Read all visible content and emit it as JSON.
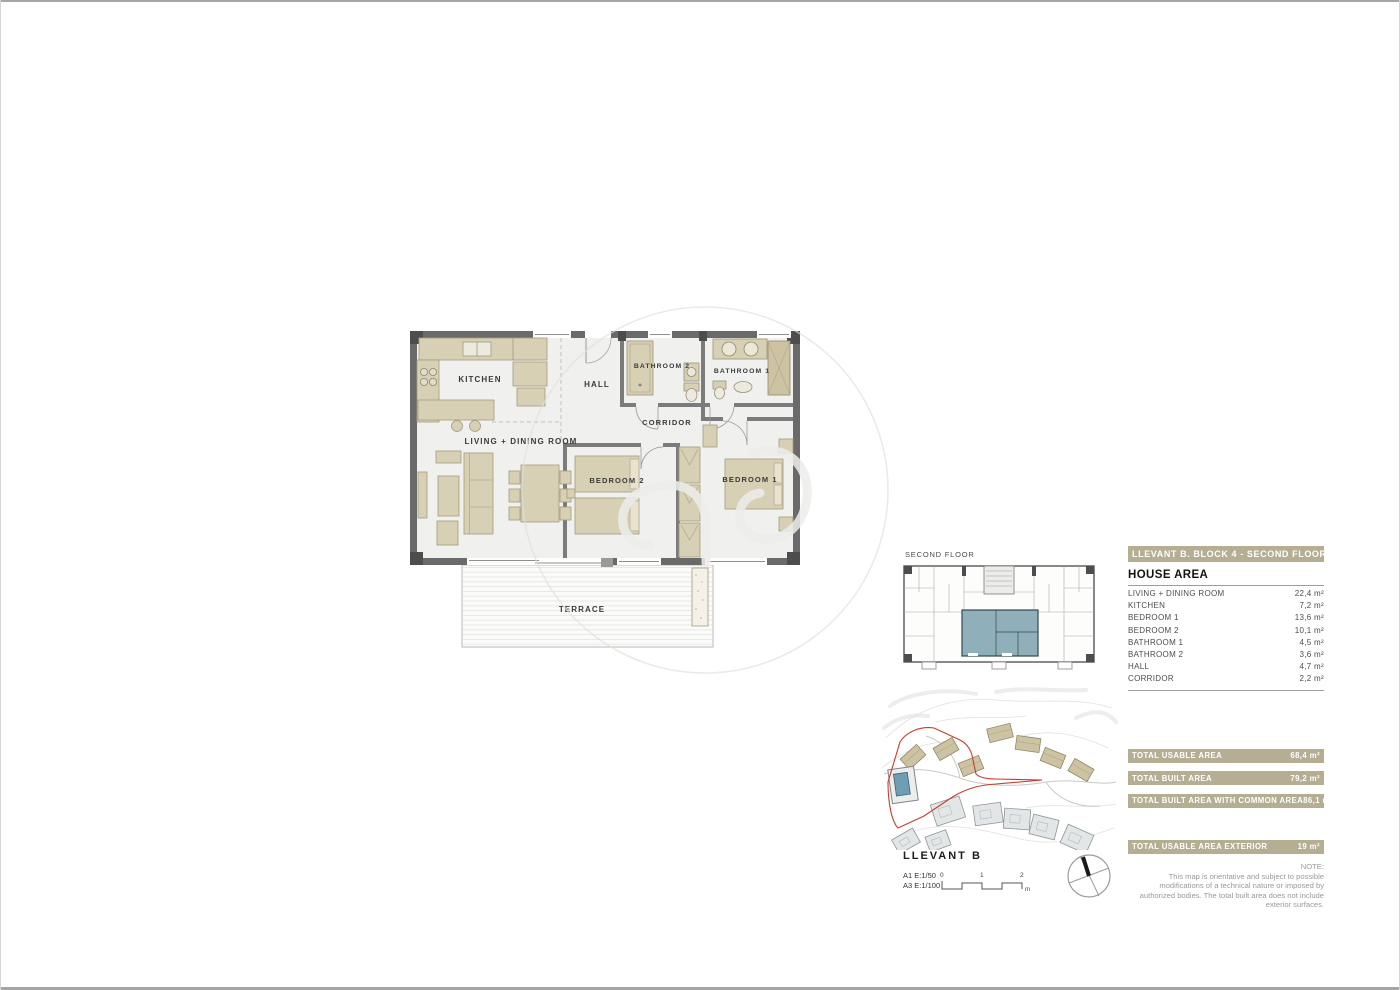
{
  "plan": {
    "labels": {
      "kitchen": "KITCHEN",
      "hall": "HALL",
      "bathroom2": "BATHROOM 2",
      "bathroom1": "BATHROOM 1",
      "corridor": "CORRIDOR",
      "living": "LIVING + DINING ROOM",
      "bedroom2": "BEDROOM 2",
      "bedroom1": "BEDROOM 1",
      "terrace": "TERRACE"
    }
  },
  "key_plan": {
    "label": "SECOND FLOOR"
  },
  "footer": {
    "project": "LLEVANT B",
    "scale_a1": "A1 E:1/50",
    "scale_a3": "A3 E:1/100",
    "ticks": [
      "0",
      "1",
      "2"
    ],
    "unit": "m"
  },
  "panel": {
    "title": "LLEVANT B. BLOCK 4 -  SECOND FLOOR 2nd",
    "house_area": {
      "heading": "HOUSE AREA",
      "rows": [
        {
          "label": "LIVING + DINING ROOM",
          "value": "22,4 m²"
        },
        {
          "label": "KITCHEN",
          "value": "7,2 m²"
        },
        {
          "label": "BEDROOM 1",
          "value": "13,6 m²"
        },
        {
          "label": "BEDROOM 2",
          "value": "10,1 m²"
        },
        {
          "label": "BATHROOM 1",
          "value": "4,5 m²"
        },
        {
          "label": "BATHROOM 2",
          "value": "3,6 m²"
        },
        {
          "label": "HALL",
          "value": "4,7 m²"
        },
        {
          "label": "CORRIDOR",
          "value": "2,2 m²"
        }
      ]
    },
    "totals": [
      {
        "label": "TOTAL USABLE AREA",
        "value": "68,4 m²"
      },
      {
        "label": "TOTAL BUILT AREA",
        "value": "79,2 m²"
      },
      {
        "label": "TOTAL BUILT AREA WITH COMMON AREA",
        "value": "86,1 m²"
      }
    ],
    "total_exterior": {
      "label": "TOTAL USABLE AREA EXTERIOR",
      "value": "19 m²"
    },
    "note": {
      "heading": "NOTE:",
      "body": "This map is orientative and subject to possible modifications of a technical nature or imposed by authorized bodies. The total built area does not include exterior surfaces."
    }
  },
  "colors": {
    "bar_beige": "#b5ae92",
    "furniture_beige": "#d8d0b4",
    "wall_gray": "#6a6a6a",
    "unit_highlight": "#8fafba",
    "boundary_red": "#c83a30",
    "pool_blue": "#6f9db3"
  }
}
